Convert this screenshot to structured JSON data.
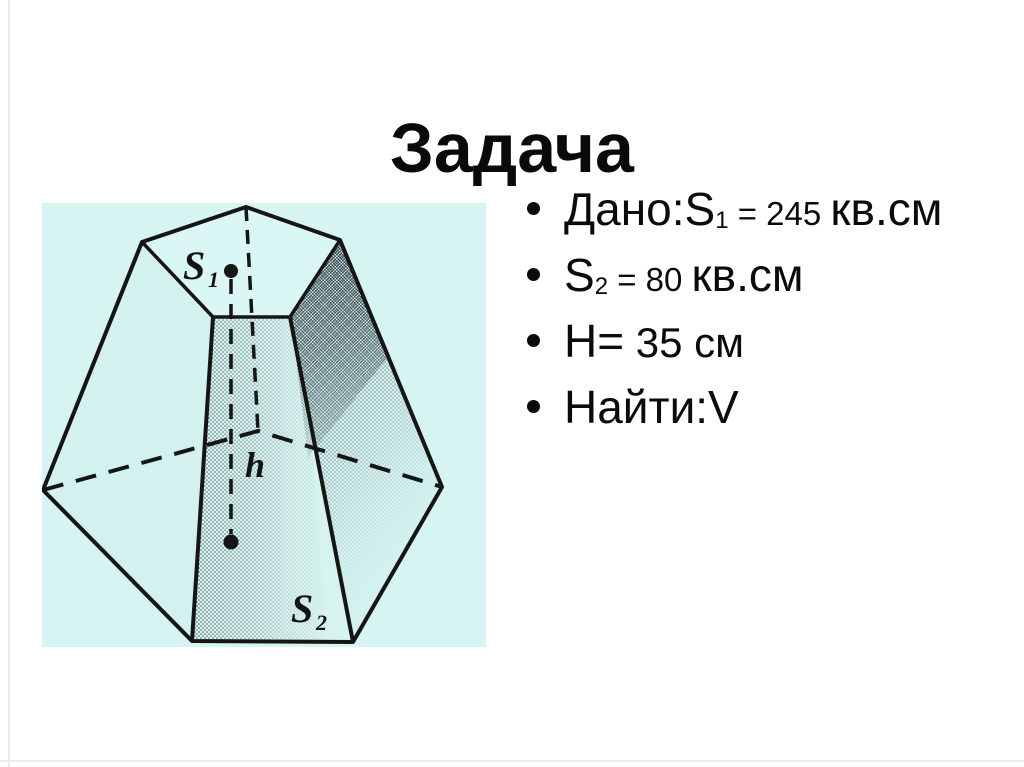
{
  "slide": {
    "title": "Задача"
  },
  "bullets": {
    "b1": {
      "lead": "Дано:S",
      "sub": "1",
      "small": " = 245 ",
      "tail": "кв.см"
    },
    "b2": {
      "lead": "S",
      "sub": "2",
      "small": " = 80 ",
      "tail": "кв.см"
    },
    "b3": {
      "lead": "H=",
      "tail": " 35 см"
    },
    "b4": {
      "text": "Найти:V"
    }
  },
  "diagram": {
    "labels": {
      "top_area": "S",
      "top_area_sub": "1",
      "height": "h",
      "bottom_area": "S",
      "bottom_area_sub": "2"
    },
    "colors": {
      "background": "#d5f4f2",
      "line": "#151515"
    }
  }
}
